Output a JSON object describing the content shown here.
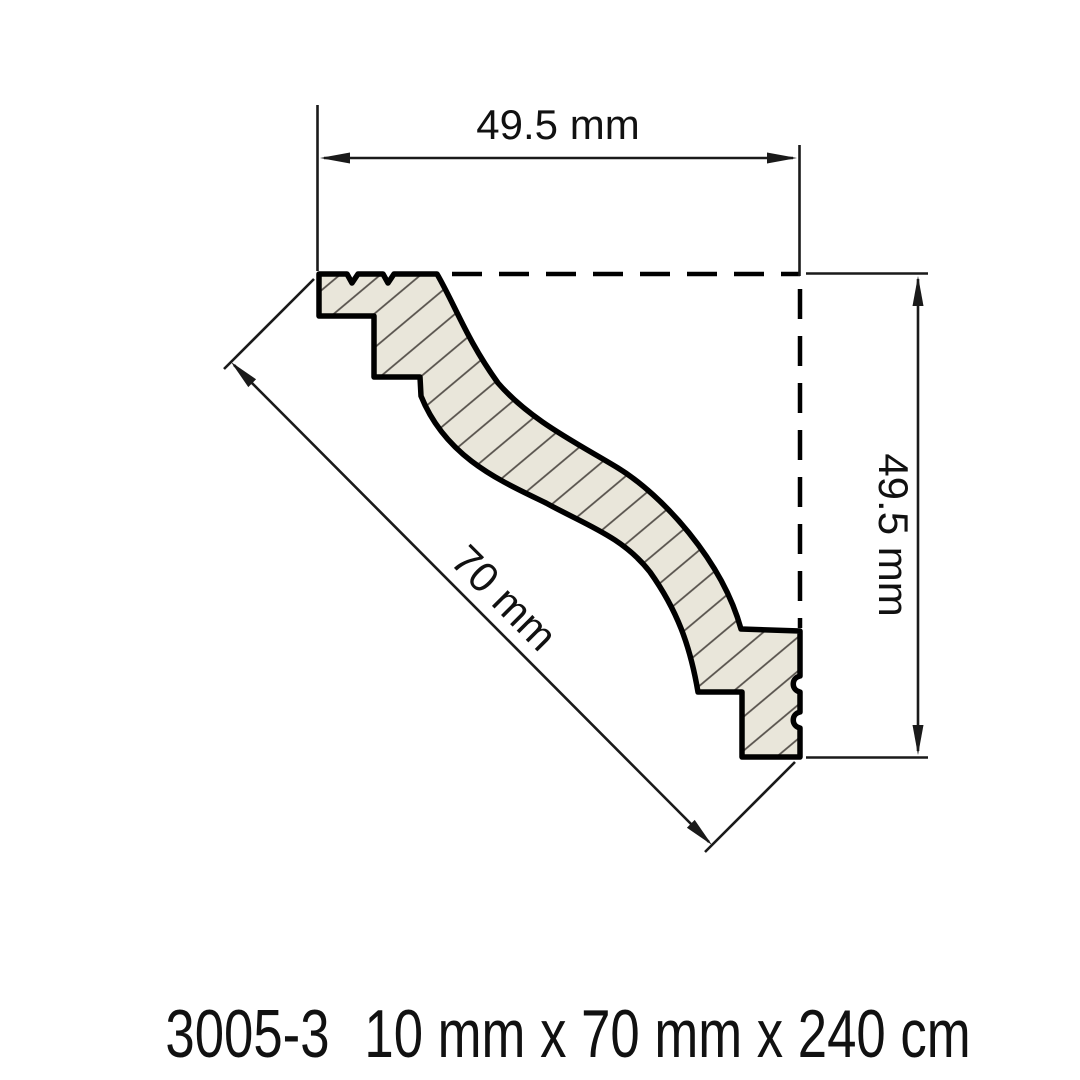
{
  "drawing": {
    "type": "crown-molding-profile-cross-section",
    "dim_width_label": "49.5 mm",
    "dim_height_label": "49.5 mm",
    "dim_length_label": "70 mm",
    "product_code": "3005-3",
    "product_size": "10 mm x 70 mm x 240 cm",
    "colors": {
      "background": "#ffffff",
      "profile_fill": "#e9e6da",
      "hatch_line": "#55504a",
      "outline": "#000000",
      "dimension_line": "#1a1a1a",
      "text": "#111111"
    }
  }
}
